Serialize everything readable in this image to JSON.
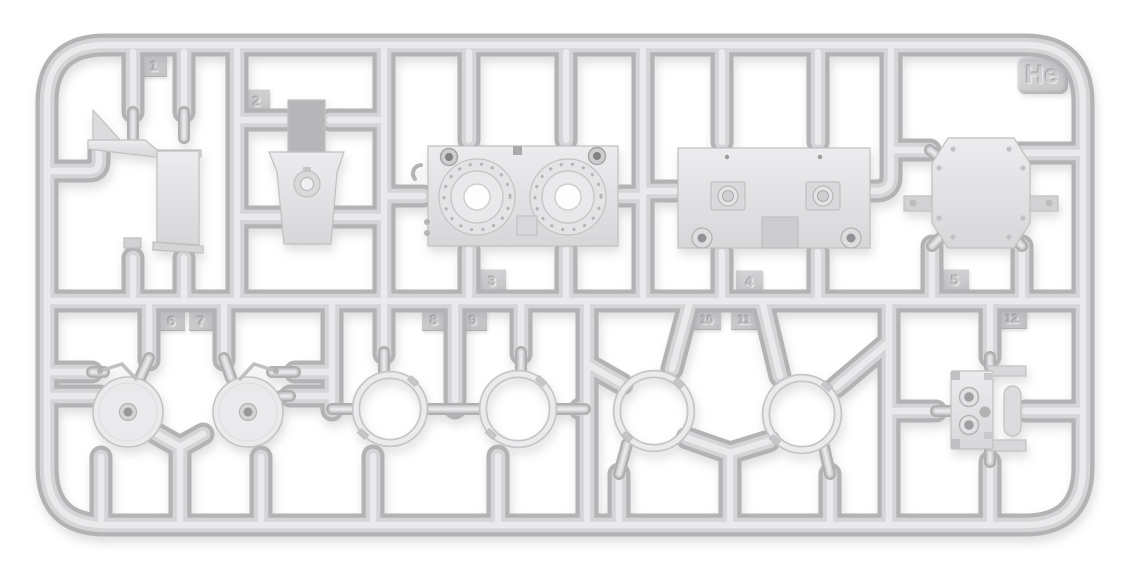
{
  "sprue": {
    "letter_tag": "He",
    "part_tags": [
      "1",
      "2",
      "3",
      "4",
      "5",
      "6",
      "7",
      "8",
      "9",
      "10",
      "11",
      "12"
    ]
  },
  "palette": {
    "background": "#ffffff",
    "plastic_base": "#cfcfd1",
    "plastic_highlight": "#ebebed",
    "plastic_shadow": "#aeaeb0",
    "part_fill_light": "#e9e9eb",
    "part_fill_dark": "#b6b6b8",
    "tag_face": "#cbcbcd",
    "hole_white": "#fdfdfe",
    "hub_dark": "#98989a"
  }
}
